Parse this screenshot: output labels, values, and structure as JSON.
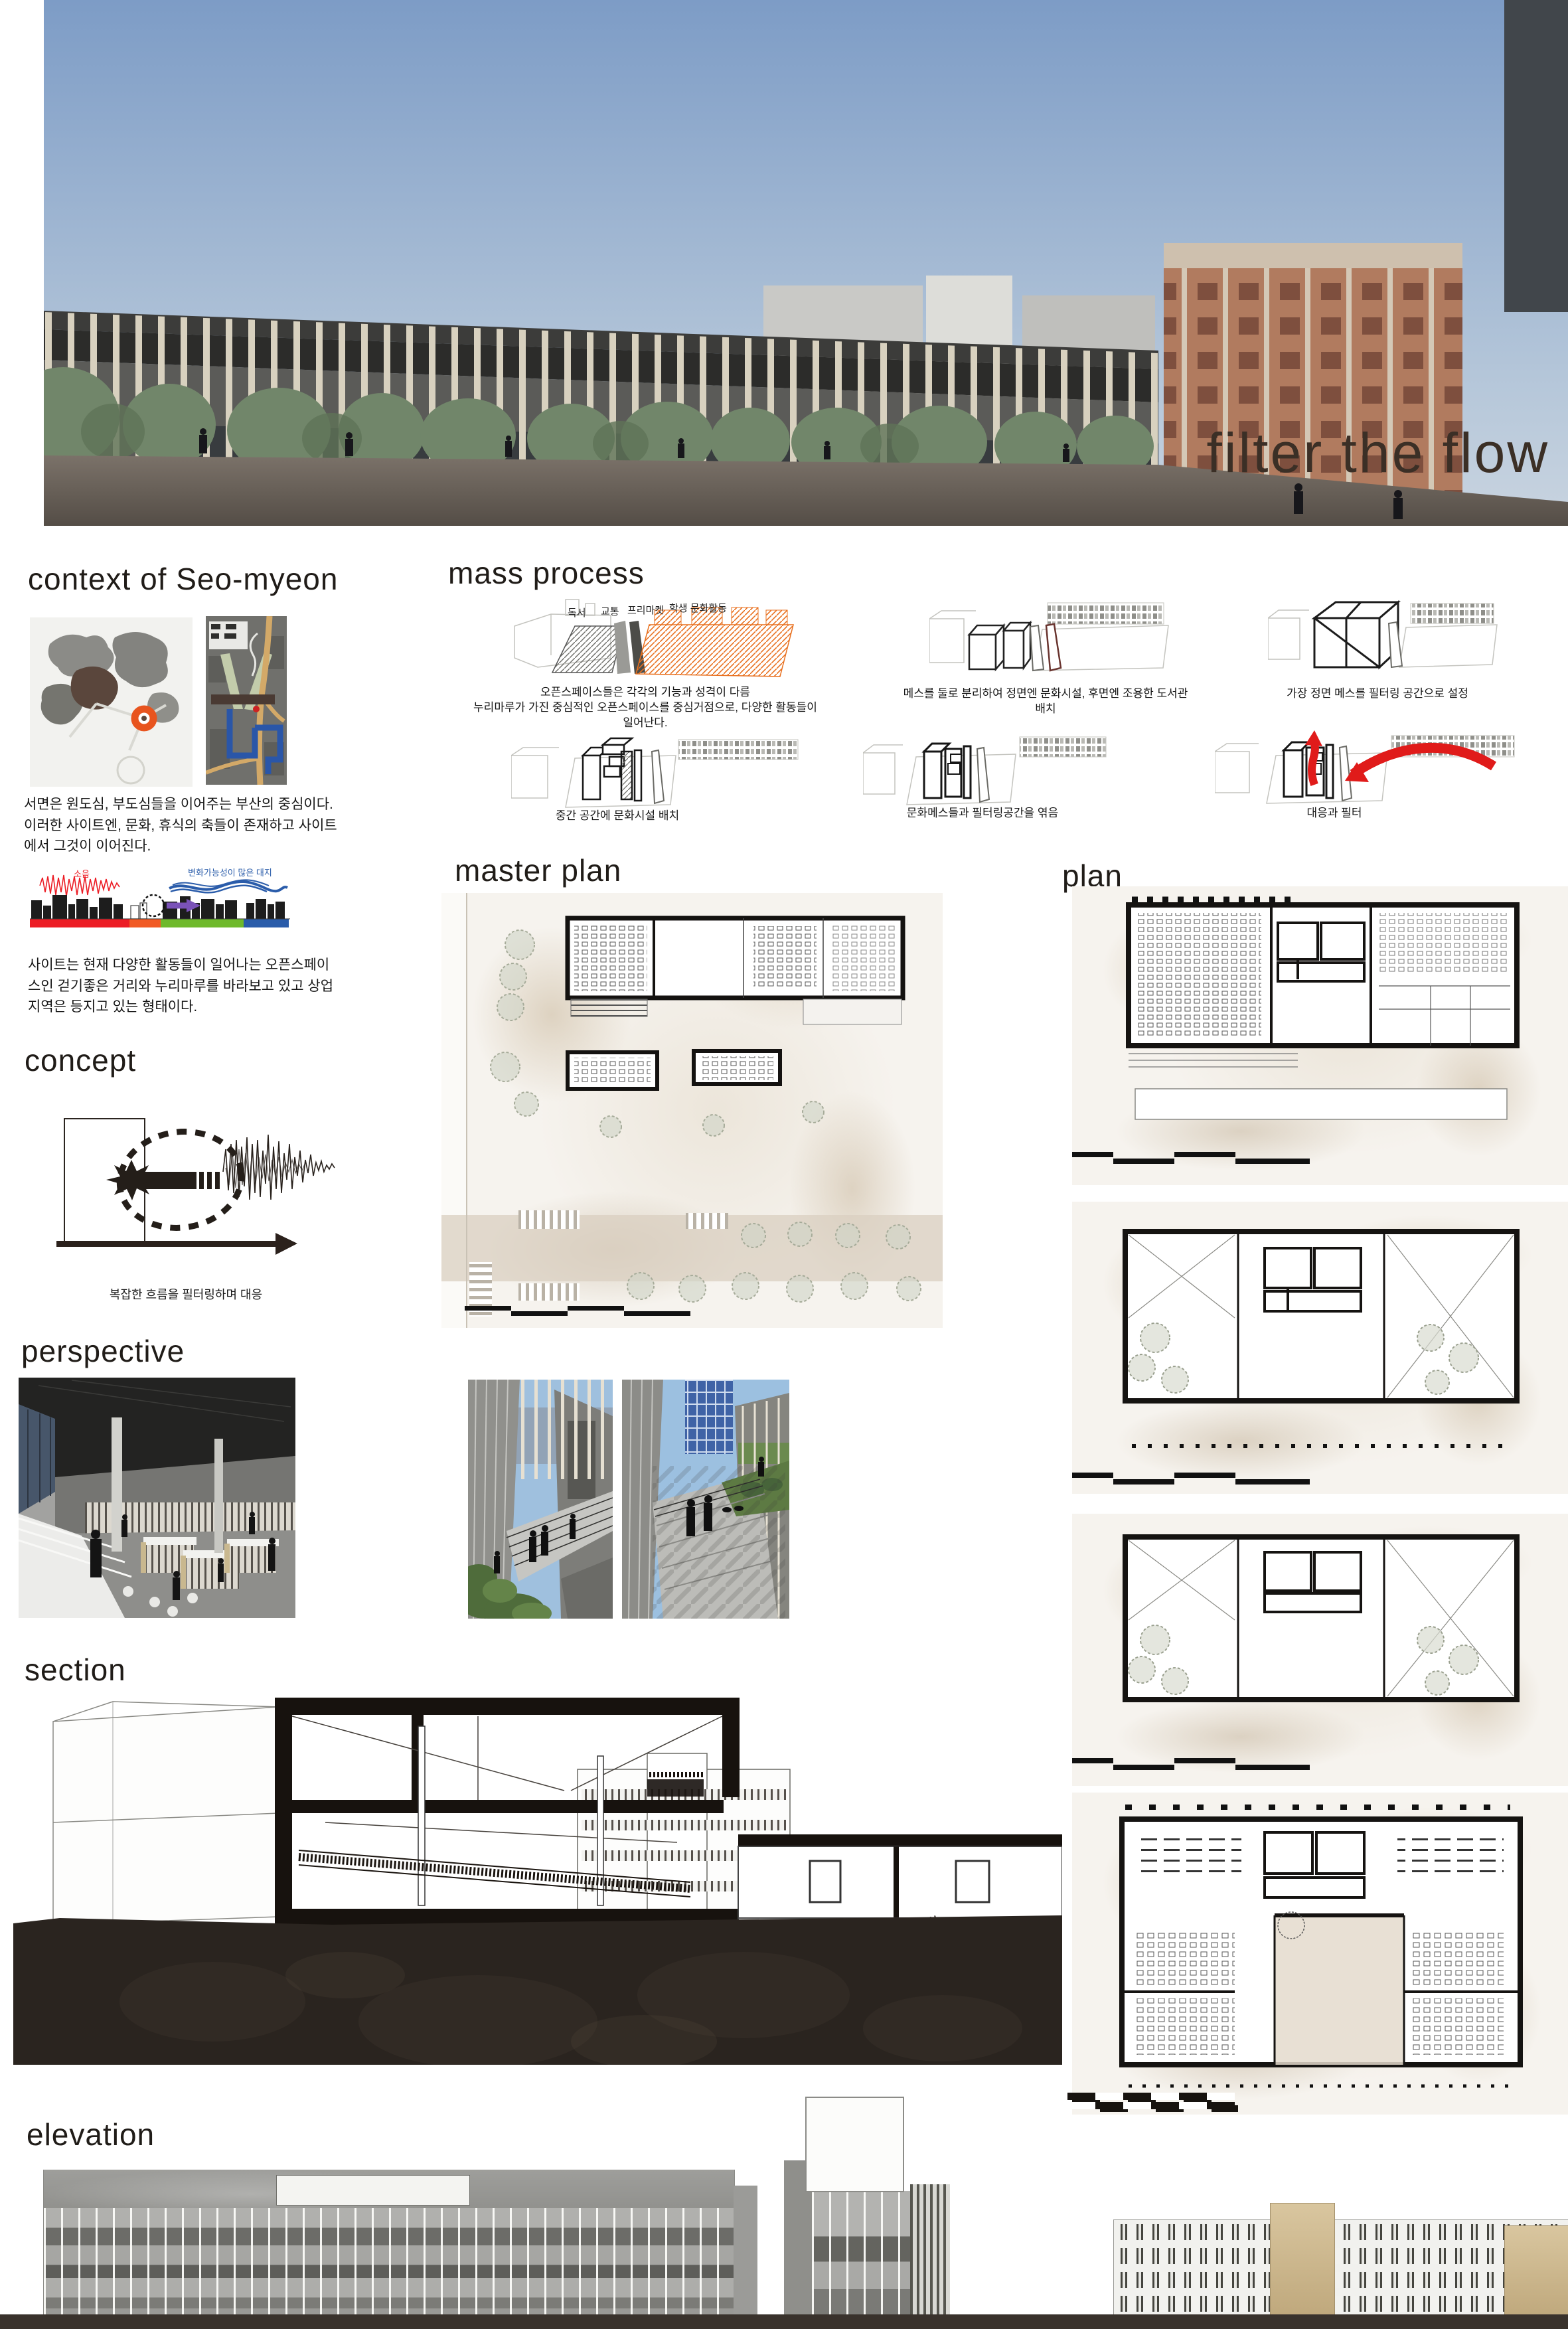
{
  "hero": {
    "title": "filter the flow"
  },
  "context": {
    "heading": "context of Seo-myeon",
    "para1": "서면은 원도심, 부도심들을 이어주는 부산의 중심이다.이러한 사이트엔, 문화, 휴식의 축들이 존재하고 사이트에서 그것이 이어진다.",
    "strip": {
      "noise_label": "소음",
      "site_label": "변화가능성이 많은 대지"
    },
    "para2": "사이트는 현재 다양한 활동들이 일어나는 오픈스페이스인 걷기좋은 거리와 누리마루를 바라보고 있고 상업지역은 등지고 있는 형태이다."
  },
  "mass": {
    "heading": "mass process",
    "diagram1_labels": [
      "독서",
      "교통",
      "프리마켓",
      "학생 문화활동"
    ],
    "caption1_line1": "오픈스페이스들은 각각의 기능과 성격이 다름",
    "caption1_line2": "누리마루가 가진  중심적인 오픈스페이스를 중심거점으로, 다양한 활동들이 일어난다.",
    "caption2": "메스를 둘로 분리하여 정면엔 문화시설, 후면엔 조용한 도서관 배치",
    "caption3": "가장 정면 메스를  필터링 공간으로 설정",
    "caption4": "중간 공간에 문화시설 배치",
    "caption5": "문화메스들과 필터링공간을 엮음",
    "caption6": "대응과 필터"
  },
  "concept": {
    "heading": "concept",
    "caption": "복잡한 흐름을 필터링하며 대응"
  },
  "master_plan": {
    "heading": "master plan"
  },
  "plan": {
    "heading": "plan"
  },
  "perspective": {
    "heading": "perspective"
  },
  "section": {
    "heading": "section"
  },
  "elevation": {
    "heading": "elevation"
  },
  "colors": {
    "title_brown": "#3b2f26",
    "site_marker_orange": "#e8541e",
    "zone_red": "#ec1c24",
    "zone_orange": "#f15a24",
    "zone_green": "#6eb92b",
    "zone_blue": "#2a5caa",
    "arrow_purple": "#7a52b8",
    "flow_arrow_red": "#e01b1a"
  }
}
